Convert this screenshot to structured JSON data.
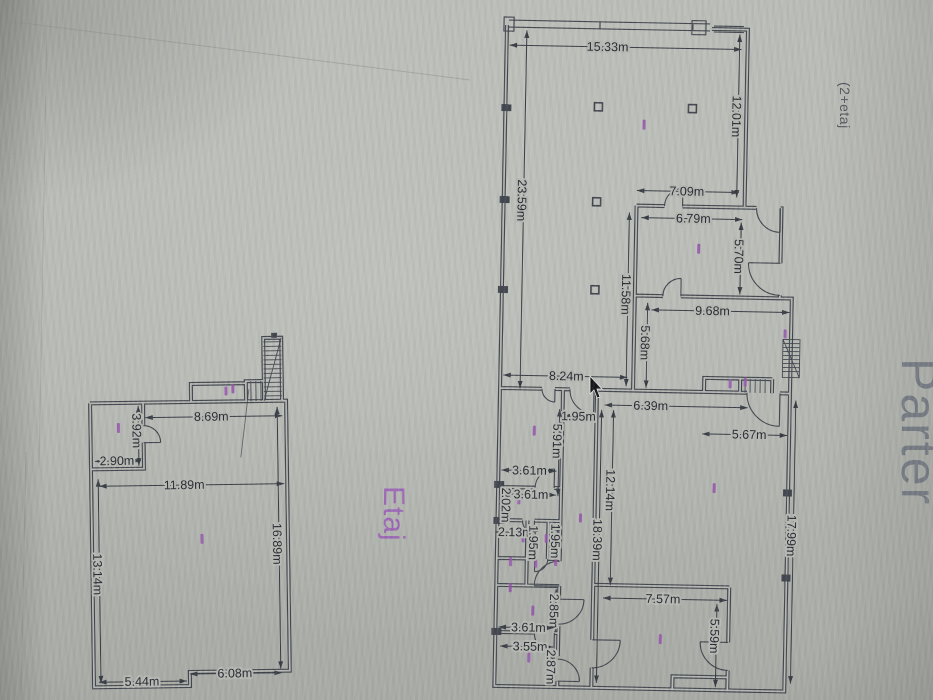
{
  "titles": {
    "left_plan": "Etaj",
    "right_plan": "Parter",
    "corner_note": "(2+etaj"
  },
  "colors": {
    "line": "#42464e",
    "purple": "#9553ad",
    "title_gray": "#70757f",
    "background": "#b2b5af"
  },
  "dims_parter": {
    "top_width": "15.33m",
    "showroom_depth": "12.01m",
    "left_side": "23.59m",
    "room1_top": "7.09m",
    "room1_width": "6.79m",
    "room1_depth": "5.70m",
    "mid_wall": "11.58m",
    "room2_side": "5.68m",
    "room2_width": "9.68m",
    "hall_top": "8.24m",
    "corridor_door": "1.95m",
    "hall_width": "6.39m",
    "hall_right": "5.67m",
    "corridor_len": "5.91m",
    "office1": "3.61m",
    "office2": "3.61m",
    "office_side": "2.02m",
    "wc_width": "2.13m",
    "wc_a": "1.95m",
    "wc_b": "1.95m",
    "room_depth": "12.14m",
    "inner_side": "18.39m",
    "store_depth": "2.85m",
    "store_width": "3.61m",
    "back_width": "3.55m",
    "back_depth": "2.87m",
    "backroom_width": "7.57m",
    "backroom_depth": "5.59m",
    "right_side": "17.99m"
  },
  "dims_etaj": {
    "top_width": "8.69m",
    "room_depth": "3.92m",
    "room_width": "2.90m",
    "hall_width": "11.89m",
    "left_side": "13.14m",
    "right_side": "16.89m",
    "bottom_left": "5.44m",
    "bottom_right": "6.08m"
  }
}
